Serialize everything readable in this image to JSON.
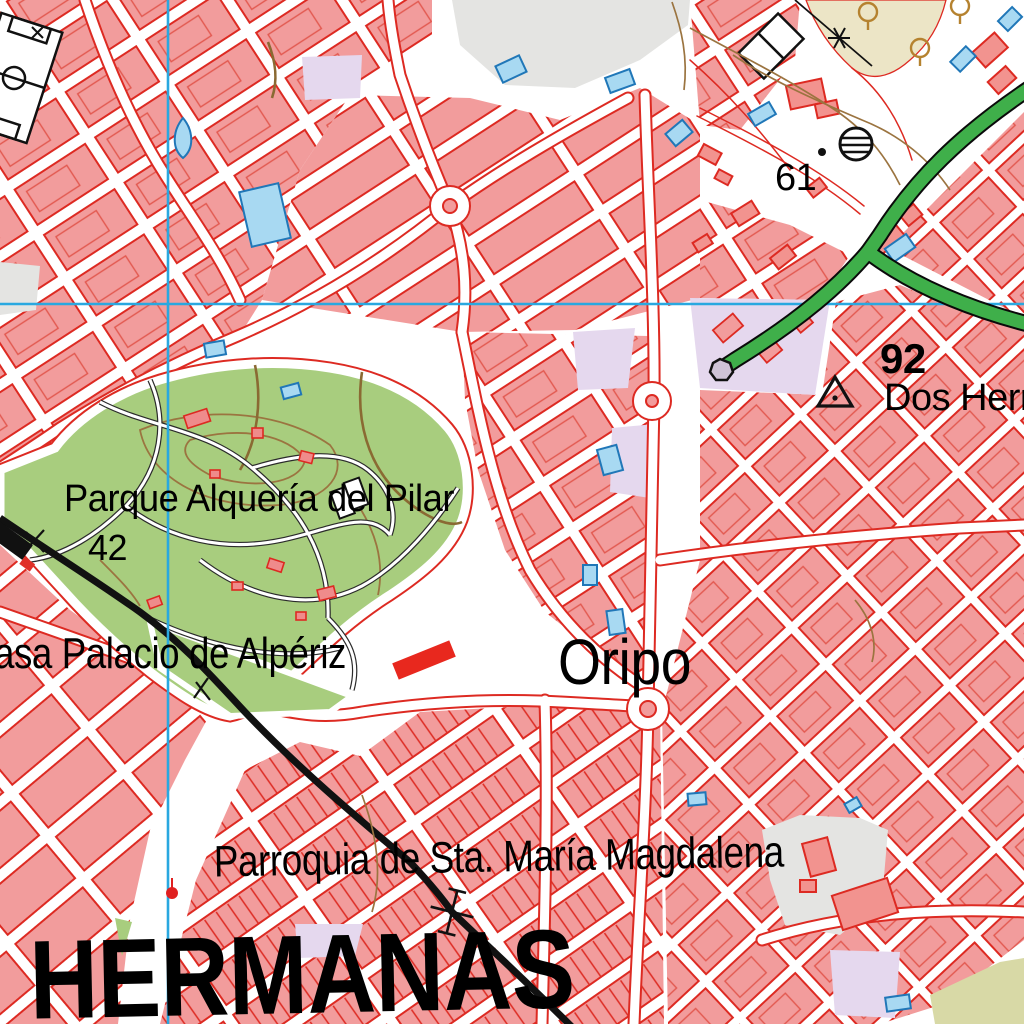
{
  "map": {
    "labels": {
      "park": "Parque Alquería del Pilar",
      "park_elevation": "42",
      "palace": "asa Palacio de Alpériz",
      "district": "Oripo",
      "church": "Parroquia de Sta. María Magdalena",
      "city": "HERMANAS",
      "place": "Dos Herm",
      "elevation_east": "92",
      "elevation_north": "61"
    },
    "colors": {
      "urban_block": "#f29c9c",
      "building_outline": "#dd2a22",
      "park_green": "#a8cd7e",
      "highway_green": "#3faf4a",
      "grid_cyan": "#29a8e0",
      "railway_black": "#111111",
      "water_building_blue": "#a8d9f2",
      "water_building_edge": "#2077b8",
      "grove_beige": "#ece5c6",
      "gray_zone": "#e4e4e2",
      "purple_zone": "#e5d8ee",
      "contour_brown": "#9b7440",
      "dirt_path_brown": "#8a6a33"
    },
    "symbols": [
      "football-field",
      "water-tower",
      "geodetic-vertex",
      "level-crossing",
      "power-pylon",
      "roundabout",
      "railway-station",
      "olive-tree",
      "highway-terminus"
    ]
  }
}
